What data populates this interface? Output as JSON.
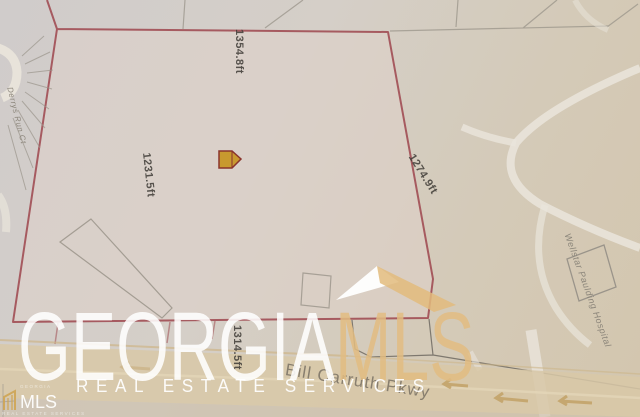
{
  "theme": {
    "paper": "#d3cec9",
    "boundary": "#a14e54",
    "road-fill": "#d8c8a7",
    "brand-tan": "#e2bd82",
    "ink": "#3f3c37"
  },
  "map": {
    "measurements": {
      "top": "1354.8ft",
      "left": "1231.5ft",
      "right": "1274.9ft",
      "bottom": "1314.5ft"
    },
    "streets": {
      "cul_de_sac": "Derrys Run Ct",
      "parkway": "Bill Carruth Pkwy"
    },
    "places": {
      "hospital": "Wellstar Paulding Hospital"
    }
  },
  "watermark": {
    "brand_primary": "GEORGIA",
    "brand_secondary": "MLS",
    "tagline": "REAL ESTATE SERVICES",
    "corner": {
      "top": "GEORGIA",
      "text": "MLS",
      "bottom": "REAL ESTATE SERVICES"
    }
  }
}
